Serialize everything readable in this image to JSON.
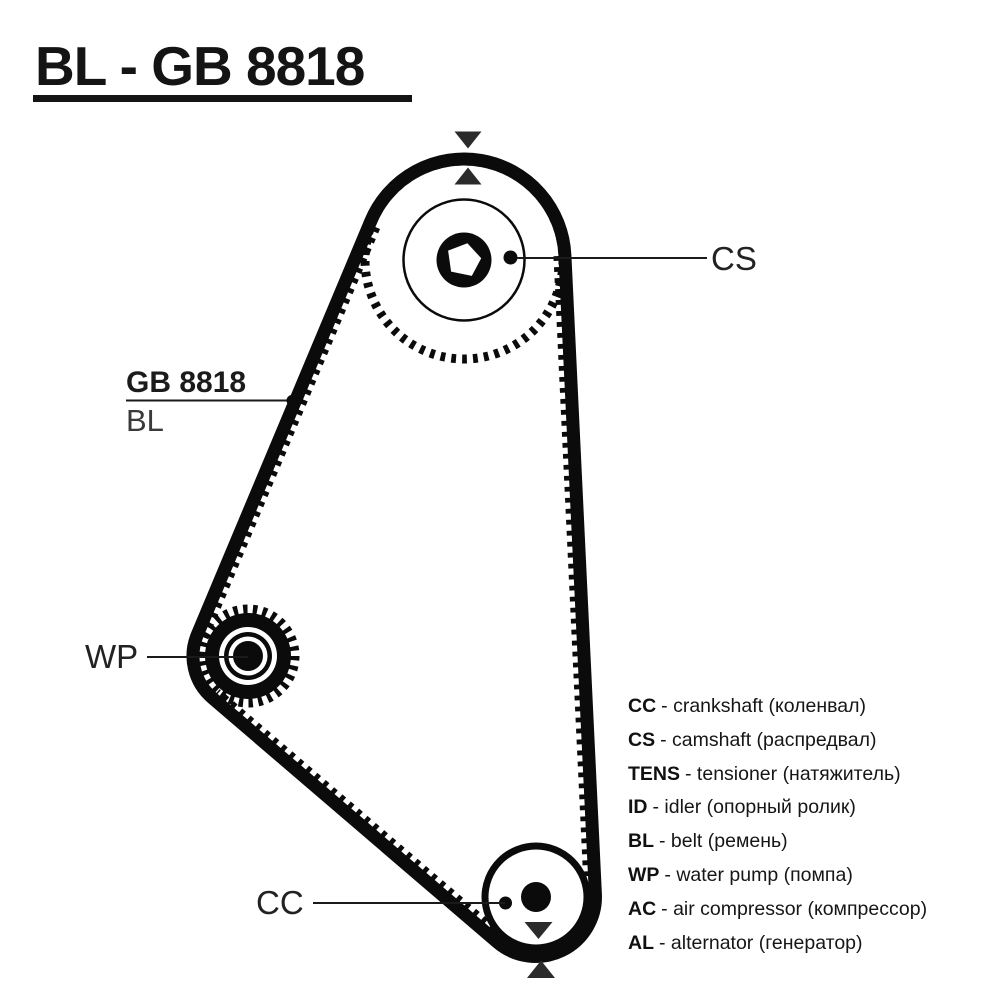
{
  "title": "BL - GB 8818",
  "diagram": {
    "belt_label": {
      "code": "GB 8818",
      "name": "BL"
    },
    "pulley_labels": {
      "camshaft": "CS",
      "water_pump": "WP",
      "crankshaft": "CC"
    }
  },
  "legend": {
    "items": [
      {
        "abbr": "CC",
        "desc": "- crankshaft (коленвал)"
      },
      {
        "abbr": "CS",
        "desc": "- camshaft (распредвал)"
      },
      {
        "abbr": "TENS",
        "desc": "- tensioner (натяжитель)"
      },
      {
        "abbr": "ID",
        "desc": "- idler (опорный ролик)"
      },
      {
        "abbr": "BL",
        "desc": "- belt (ремень)"
      },
      {
        "abbr": "WP",
        "desc": "- water pump (помпа)"
      },
      {
        "abbr": "AC",
        "desc": "- air compressor (компрессор)"
      },
      {
        "abbr": "AL",
        "desc": "- alternator (генератор)"
      }
    ]
  },
  "colors": {
    "ink": "#0b0b0b",
    "background": "#ffffff",
    "timing_mark": "#2b2b2b"
  }
}
